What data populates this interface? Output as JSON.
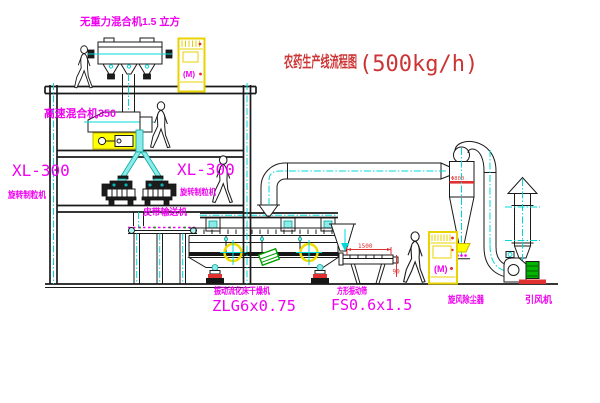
{
  "title": {
    "name": "农药生产线流程图",
    "capacity": "(500kg/h)"
  },
  "labels": {
    "gravity_mixer": "无重力混合机1.5 立方",
    "high_speed_mixer": "高速混合机350",
    "left_granulator_model": "XL-300",
    "left_granulator_name": "旋转制粒机",
    "right_granulator_model": "XL-300",
    "right_granulator_name": "旋转制粒机",
    "belt_conveyor": "皮带输送机",
    "dryer_name": "振动流化床干燥机",
    "dryer_model": "ZLG6x0.75",
    "sieve_name": "方形振动筛",
    "sieve_model": "FS0.6x1.5",
    "cyclone": "旋风除尘器",
    "fan": "引风机",
    "cabinet_motor_mark": "(M)"
  },
  "dimensions": {
    "sieve_width": "1500",
    "sieve_height": "90",
    "cyclone_diameter": "Φ800"
  },
  "colors": {
    "line": "#1a1a1a",
    "centerline": "#00d8d8",
    "label": "#f000f0",
    "title": "#cc3333",
    "dimension": "#e03030",
    "highlight": "#ffff00",
    "motor_green": "#00b400"
  }
}
